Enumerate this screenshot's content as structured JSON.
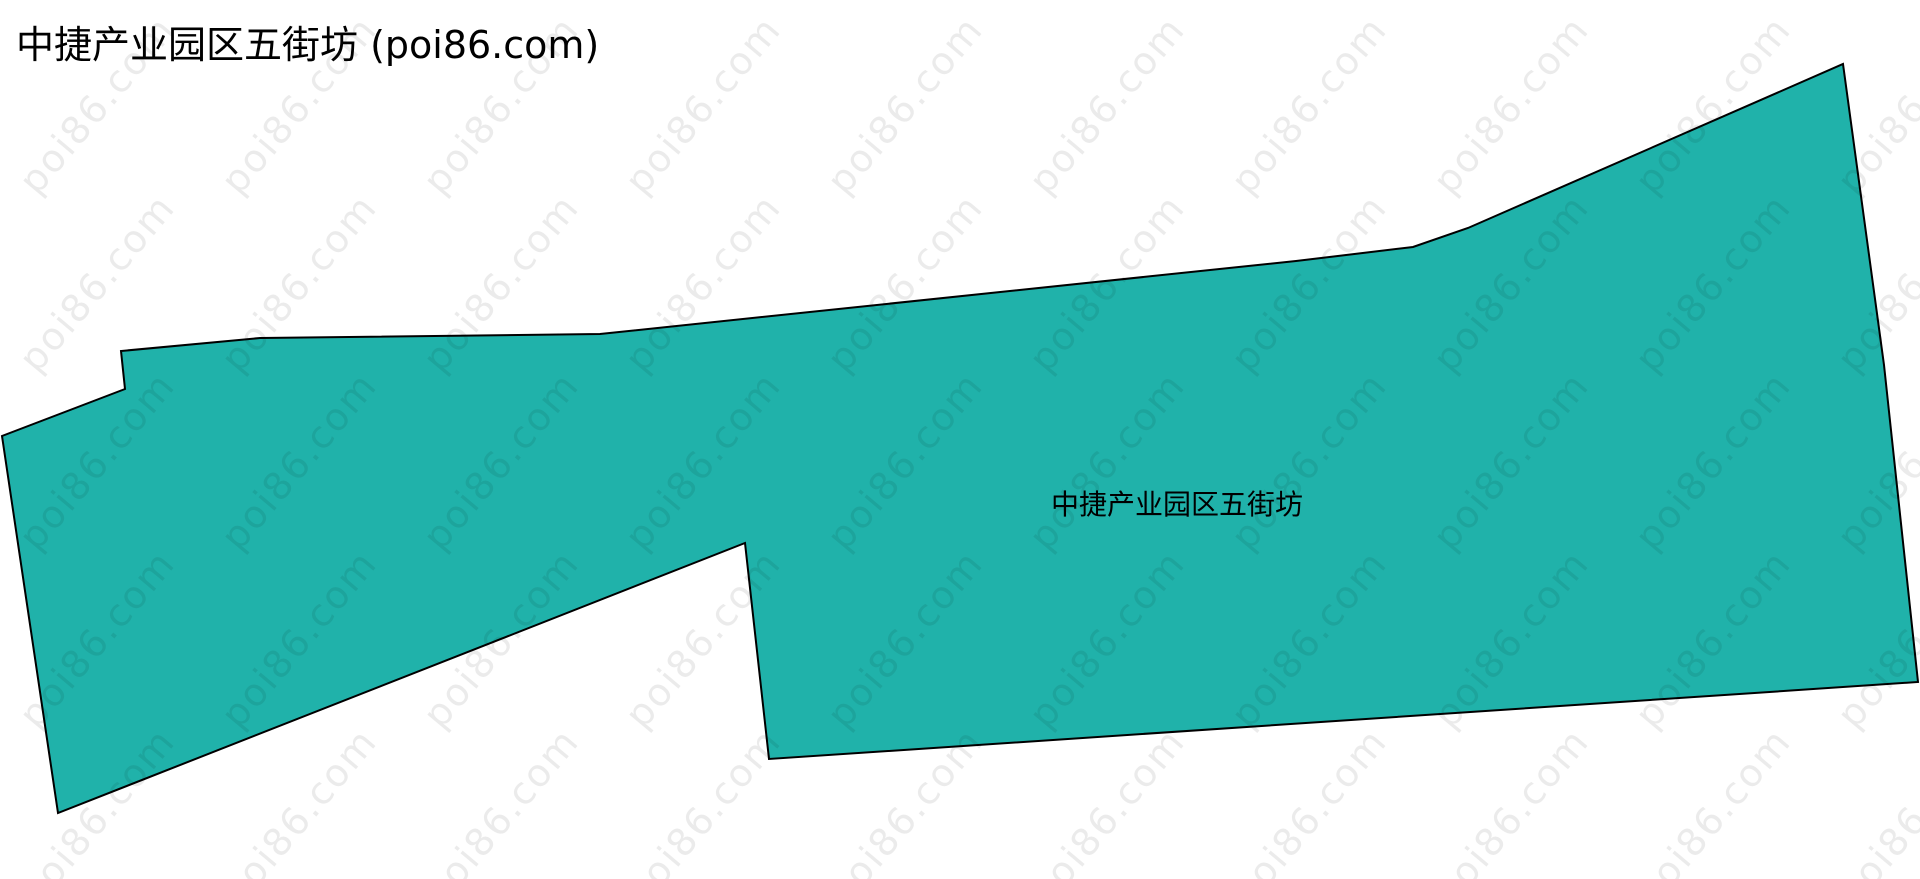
{
  "page": {
    "title": "中捷产业园区五街坊 (poi86.com)",
    "background_color": "#ffffff"
  },
  "map": {
    "region_label": "中捷产业园区五街坊",
    "polygon": {
      "fill_color": "#20b2aa",
      "stroke_color": "#000000",
      "stroke_width": 2,
      "points": [
        [
          1843,
          64
        ],
        [
          1884,
          365
        ],
        [
          1918,
          682
        ],
        [
          769,
          759
        ],
        [
          745,
          543
        ],
        [
          58,
          813
        ],
        [
          2,
          436
        ],
        [
          125,
          389
        ],
        [
          121,
          351
        ],
        [
          260,
          338
        ],
        [
          600,
          334
        ],
        [
          1296,
          261
        ],
        [
          1413,
          247
        ],
        [
          1468,
          228
        ]
      ]
    }
  },
  "watermark": {
    "text": "poi86.com",
    "color": "rgba(0, 0, 0, 0.08)"
  }
}
